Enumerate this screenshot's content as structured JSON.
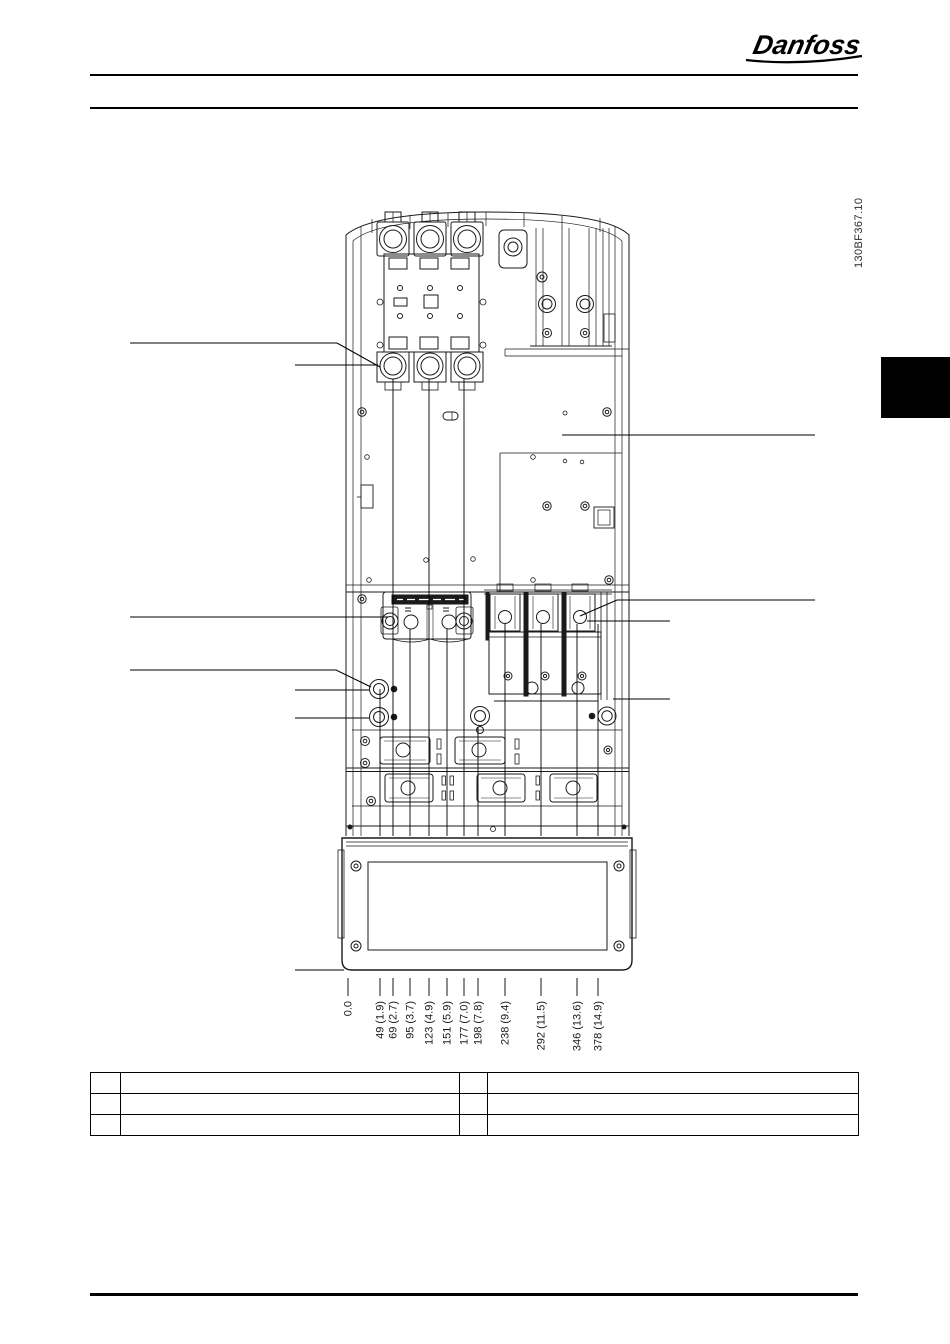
{
  "page": {
    "logo_text": "Danfoss",
    "figure_code": "130BF367.10"
  },
  "dimensions": {
    "labels": [
      "0.0",
      "49 (1.9)",
      "69 (2.7)",
      "95 (3.7)",
      "123 (4.9)",
      "151 (5.9)",
      "177 (7.0)",
      "198 (7.8)",
      "238 (9.4)",
      "292 (11.5)",
      "346 (13.6)",
      "378 (14.9)"
    ]
  },
  "legend_table": {
    "rows": [
      [
        "",
        "",
        "",
        ""
      ],
      [
        "",
        "",
        "",
        ""
      ],
      [
        "",
        "",
        "",
        ""
      ]
    ]
  },
  "colors": {
    "line": "#1a1a1a",
    "tab": "#000000"
  }
}
